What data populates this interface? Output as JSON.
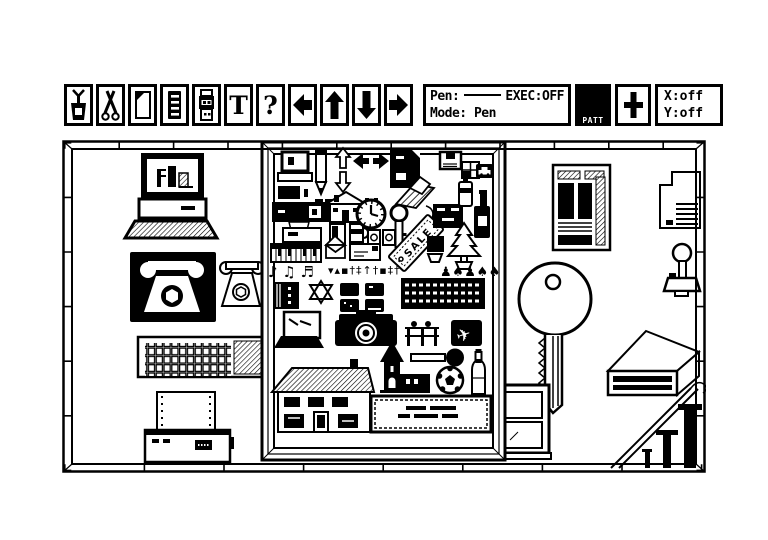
{
  "app": {
    "background": "#ffffff",
    "ink": "#000000"
  },
  "toolbar": {
    "buttons": [
      {
        "name": "paste-tool",
        "icon": "glue-pot-icon"
      },
      {
        "name": "cut-tool",
        "icon": "scissors-icon"
      },
      {
        "name": "new-page-tool",
        "icon": "blank-page-icon"
      },
      {
        "name": "document-tool",
        "icon": "notepad-icon"
      },
      {
        "name": "film-tool",
        "icon": "film-roll-icon"
      },
      {
        "name": "text-tool",
        "icon": "text-icon",
        "glyph": "T"
      },
      {
        "name": "help-tool",
        "icon": "question-icon",
        "glyph": "?"
      },
      {
        "name": "scroll-left",
        "icon": "arrow-left-icon"
      },
      {
        "name": "scroll-up",
        "icon": "arrow-up-icon"
      },
      {
        "name": "scroll-down",
        "icon": "arrow-down-icon"
      },
      {
        "name": "scroll-right",
        "icon": "arrow-right-icon"
      }
    ],
    "status": {
      "pen_label": "Pen:",
      "exec": "EXEC:OFF",
      "mode": "Mode: Pen"
    },
    "pattern": {
      "label": "PATT",
      "fill": "#000000"
    },
    "crosshair_icon": "plus-icon",
    "coords": {
      "x": "X:off",
      "y": "Y:off"
    }
  },
  "canvas": {
    "sale_label": "SALE",
    "music_notes": "♪ ♫ ♬",
    "tiny_glyph_row": "▾▴▪†‡↑†▪‡†",
    "people_trees_row": "♟♠♟♠♠",
    "items": [
      "desktop-computer",
      "rotary-phone-inverted",
      "rotary-phone-outline",
      "computer-keyboard",
      "dot-matrix-printer",
      "framed-clipart-collage",
      "newspaper-page",
      "disk-drive",
      "joystick",
      "large-key",
      "flat-box-3d",
      "window",
      "staircase-banister"
    ],
    "collage_items": [
      "mini-computer",
      "pencil",
      "up-down-arrows",
      "left-right-arrows",
      "dark-page",
      "floppy-disk",
      "window-pane-icon",
      "car-inverted",
      "small-house",
      "banner",
      "door",
      "mug",
      "mini-copier",
      "clock",
      "small-key",
      "picture-frames",
      "sale-tag",
      "chisel",
      "dresser",
      "spray-can",
      "wine-bottle",
      "plant-pot",
      "potted-pine",
      "piano-keys",
      "open-envelope",
      "letter",
      "music-notes",
      "glyph-row",
      "people-and-trees",
      "book",
      "star-of-david",
      "tv-screens",
      "film-strip",
      "laptop",
      "camera",
      "bleachers",
      "jet-inverted",
      "large-house",
      "church",
      "frying-pan",
      "soccer-ball",
      "tall-bottle",
      "text-sign"
    ]
  }
}
